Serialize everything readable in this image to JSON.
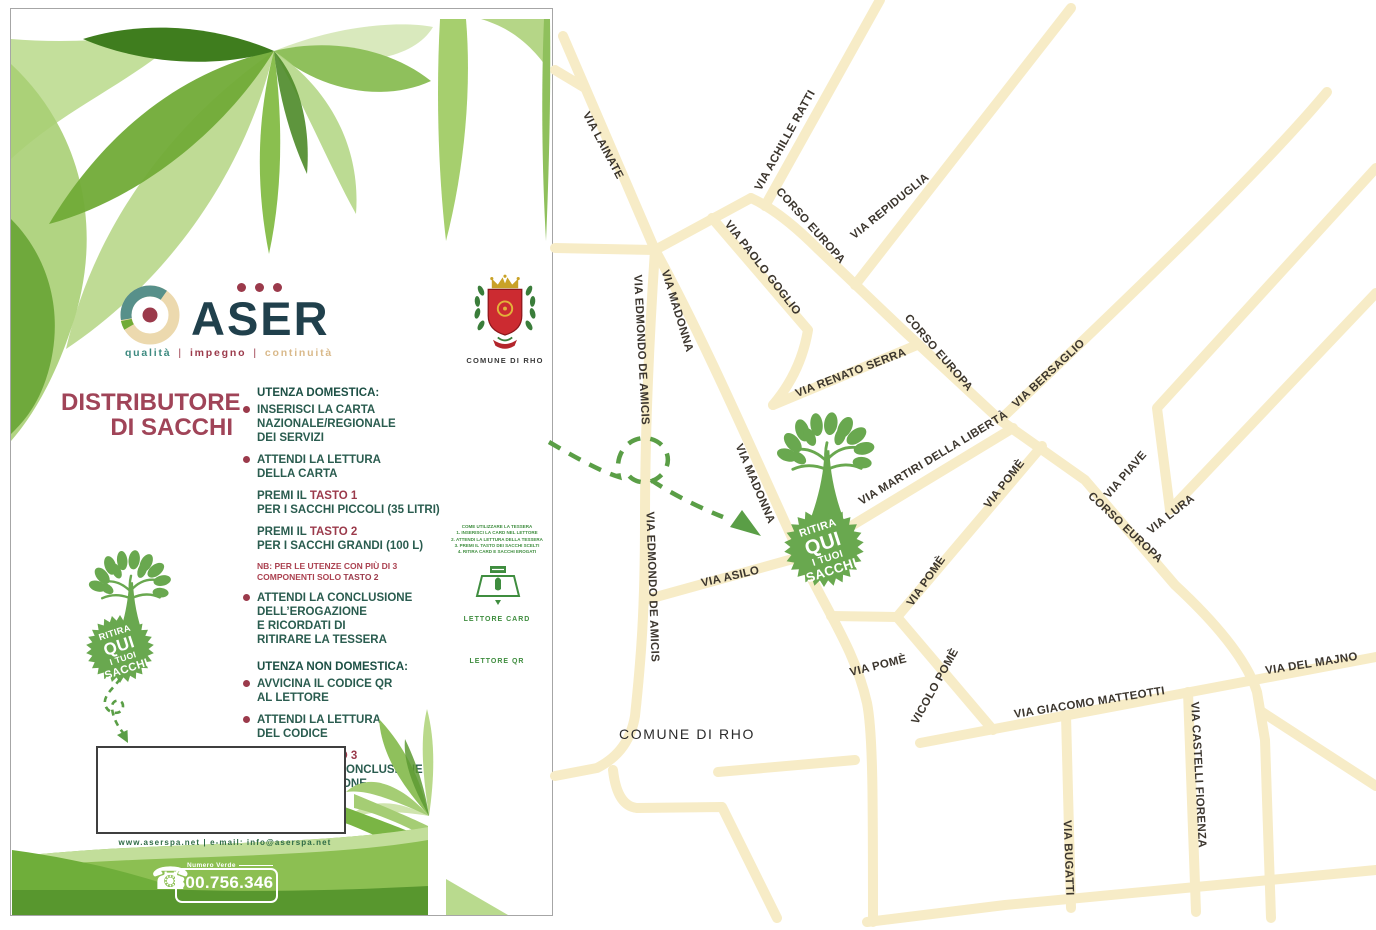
{
  "colors": {
    "accentGreen": "#69a84f",
    "arrowGreen": "#5a9e46",
    "road": "#f7ecc7",
    "mapLabel": "#3c362e",
    "maroon": "#9b3a4b",
    "titleMaroon": "#a04458",
    "bodyGreen": "#2a5c4f",
    "headingGreen": "#1c4f44",
    "noteRed": "#ab4150",
    "navy": "#20404c",
    "taglineTeal": "#3d8a80",
    "taglineTan": "#d9b98a",
    "footerGreen": "#2e6b45",
    "sideGreen": "#3f8d3f",
    "crestRed": "#cc2b31",
    "crestGold": "#c9a227",
    "crestGreen": "#3a7d3a"
  },
  "flyer": {
    "logo": {
      "brand": "ASER",
      "dots": 3,
      "tagline": [
        "qualità",
        "impegno",
        "continuità"
      ]
    },
    "title_lines": [
      "DISTRIBUTORE",
      "DI SACCHI"
    ],
    "domestic": {
      "heading": "UTENZA DOMESTICA:",
      "items": [
        {
          "b": 1,
          "lines": [
            "INSERISCI LA CARTA",
            "NAZIONALE/REGIONALE",
            "DEI SERVIZI"
          ]
        },
        {
          "b": 1,
          "lines": [
            "ATTENDI LA LETTURA",
            "DELLA CARTA"
          ]
        },
        {
          "lines": [
            [
              [
                "PREMI IL ",
                0
              ],
              [
                "TASTO 1",
                1
              ]
            ],
            "PER I SACCHI PICCOLI (35 LITRI)"
          ]
        },
        {
          "lines": [
            [
              [
                "PREMI IL ",
                0
              ],
              [
                "TASTO 2",
                1
              ]
            ],
            "PER I SACCHI GRANDI (100 L)"
          ]
        },
        {
          "n": 1,
          "lines": [
            "NB: PER LE UTENZE CON PIÙ DI 3",
            [
              [
                "COMPONENTI SOLO ",
                0
              ],
              [
                "TASTO 2",
                1
              ]
            ]
          ]
        },
        {
          "b": 1,
          "lines": [
            "ATTENDI LA CONCLUSIONE",
            "DELL’EROGAZIONE",
            "E RICORDATI DI",
            "RITIRARE LA TESSERA"
          ]
        }
      ]
    },
    "nondomestic": {
      "heading": "UTENZA NON DOMESTICA:",
      "items": [
        {
          "b": 1,
          "lines": [
            "AVVICINA IL CODICE QR",
            "AL LETTORE"
          ]
        },
        {
          "b": 1,
          "lines": [
            "ATTENDI LA LETTURA",
            "DEL CODICE"
          ]
        },
        {
          "b": 1,
          "lines": [
            [
              [
                "PREMI IL ",
                0
              ],
              [
                "TASTO 3",
                1
              ]
            ],
            "E ATTENDI LA CONCLUSIONE",
            "DELL’EROGAZIONE"
          ]
        }
      ]
    },
    "badge_lines": [
      "RITIRA",
      "QUI",
      "I TUOI",
      "SACCHI"
    ],
    "badge": {
      "cx": 38,
      "cy": 37,
      "r": 34,
      "rot": -18
    },
    "arrow": {
      "d": "M27,6 C20,16 8,24 13,34 C17,42 30,42 30,33 C30,25 18,26 19,35 C20,46 26,55 31,61",
      "head": "35,70 34.5,57 24,62"
    },
    "footer": {
      "website_line": "www.aserspa.net | e-mail: info@aserspa.net",
      "green_number_label": "Numero Verde",
      "green_number": "800.756.346"
    },
    "side": {
      "crest_caption": "COMUNE DI RHO",
      "mini_heading": "COME UTILIZZARE LA TESSERA",
      "mini_lines": [
        "1. INSERISCI LA CARD NEL LETTORE",
        "2. ATTENDI LA LETTURA DELLA TESSERA",
        "3. PREMI IL TASTO DEI SACCHI SCELTI",
        "4. RITIRA CARD E SACCHI EROGATI"
      ],
      "reader_card_label": "LETTORE CARD",
      "reader_qr_label": "LETTORE QR"
    }
  },
  "map": {
    "place_label": "COMUNE DI RHO",
    "place_pos": {
      "x": 132,
      "y": 739
    },
    "roads": [
      {
        "d": "M8,36 L100,250"
      },
      {
        "d": "M30,88 L0,70"
      },
      {
        "d": "M0,248 L100,250"
      },
      {
        "d": "M100,250 C94,340 90,430 90,520 C90,610 86,660 80,716 Q74,752 42,768 L0,776"
      },
      {
        "d": "M58,770 Q62,806 82,808 L167,807 L222,918"
      },
      {
        "d": "M163,772 L300,760"
      },
      {
        "d": "M100,250 C150,340 210,480 245,555 C272,612 300,650 312,703 C318,733 318,800 318,922"
      },
      {
        "d": "M90,600 L245,557"
      },
      {
        "d": "M100,250 L196,198"
      },
      {
        "d": "M325,0 L210,206"
      },
      {
        "d": "M196,198 C218,208 240,226 262,248 L348,330 L445,420 L530,480 L620,585 Q688,648 702,692 L710,740 L716,918"
      },
      {
        "d": "M157,218 L253,330 Q246,372 218,405"
      },
      {
        "d": "M218,405 L362,345"
      },
      {
        "d": "M300,285 L516,8"
      },
      {
        "d": "M445,420 C560,310 700,178 772,92"
      },
      {
        "d": "M240,560 L458,428"
      },
      {
        "d": "M821,168 L602,408 L615,510"
      },
      {
        "d": "M615,510 L821,293"
      },
      {
        "d": "M487,446 L342,617"
      },
      {
        "d": "M342,617 L276,616"
      },
      {
        "d": "M342,617 L438,730"
      },
      {
        "d": "M365,743 L821,657"
      },
      {
        "d": "M633,692 L641,912"
      },
      {
        "d": "M511,715 L516,908"
      },
      {
        "d": "M312,922 L450,905 L821,870"
      },
      {
        "d": "M707,712 L821,786"
      }
    ],
    "labels": [
      {
        "t": "VIA LAINATE",
        "x": 45,
        "y": 147,
        "r": 62
      },
      {
        "t": "VIA ACHILLE RATTI",
        "x": 233,
        "y": 142,
        "r": -61
      },
      {
        "t": "CORSO EUROPA",
        "x": 253,
        "y": 228,
        "r": 48
      },
      {
        "t": "VIA REPIDUGLIA",
        "x": 337,
        "y": 209,
        "r": -39
      },
      {
        "t": "VIA PAOLO GOGLIO",
        "x": 205,
        "y": 270,
        "r": 52
      },
      {
        "t": "VIA MADONNA",
        "x": 119,
        "y": 312,
        "r": 73
      },
      {
        "t": "VIA EDMONDO DE AMICIS",
        "x": 83,
        "y": 350,
        "r": 87
      },
      {
        "t": "VIA MADONNA",
        "x": 197,
        "y": 485,
        "r": 67
      },
      {
        "t": "VIA EDMONDO DE AMICIS",
        "x": 94,
        "y": 587,
        "r": 88
      },
      {
        "t": "VIA RENATO SERRA",
        "x": 297,
        "y": 376,
        "r": -21
      },
      {
        "t": "CORSO EUROPA",
        "x": 381,
        "y": 355,
        "r": 49
      },
      {
        "t": "VIA BERSAGLIO",
        "x": 496,
        "y": 376,
        "r": -43
      },
      {
        "t": "VIA MARTIRI DELLA LIBERTÀ",
        "x": 380,
        "y": 461,
        "r": -31
      },
      {
        "t": "VIA POMÈ",
        "x": 452,
        "y": 486,
        "r": -52
      },
      {
        "t": "VIA PIAVE",
        "x": 573,
        "y": 477,
        "r": -49
      },
      {
        "t": "CORSO EUROPA",
        "x": 568,
        "y": 530,
        "r": 43
      },
      {
        "t": "VIA LURA",
        "x": 618,
        "y": 517,
        "r": -38
      },
      {
        "t": "VIA ASILO",
        "x": 176,
        "y": 580,
        "r": -13
      },
      {
        "t": "VIA POMÈ",
        "x": 374,
        "y": 583,
        "r": -55
      },
      {
        "t": "VIA POMÈ",
        "x": 324,
        "y": 669,
        "r": -14
      },
      {
        "t": "VICOLO POMÈ",
        "x": 383,
        "y": 688,
        "r": -61
      },
      {
        "t": "VIA GIACOMO MATTEOTTI",
        "x": 535,
        "y": 706,
        "r": -9
      },
      {
        "t": "VIA DEL MAJNO",
        "x": 757,
        "y": 667,
        "r": -9
      },
      {
        "t": "VIA CASTELLI FIORENZA",
        "x": 640,
        "y": 775,
        "r": 87
      },
      {
        "t": "VIA BUGATTI",
        "x": 510,
        "y": 858,
        "r": 88
      }
    ],
    "tree": {
      "x": 272,
      "y": 437,
      "s": 0.95
    },
    "badge": {
      "cx": 269,
      "cy": 547,
      "r": 40,
      "rot": -18
    },
    "arrow": {
      "d": "M-6,442 C28,462 48,472 64,477 C58,450 78,434 96,439 C114,444 119,465 104,477 C93,486 76,483 71,471 M96,480 C120,496 148,509 168,517",
      "head": "206,536 187,510 175,527"
    }
  }
}
